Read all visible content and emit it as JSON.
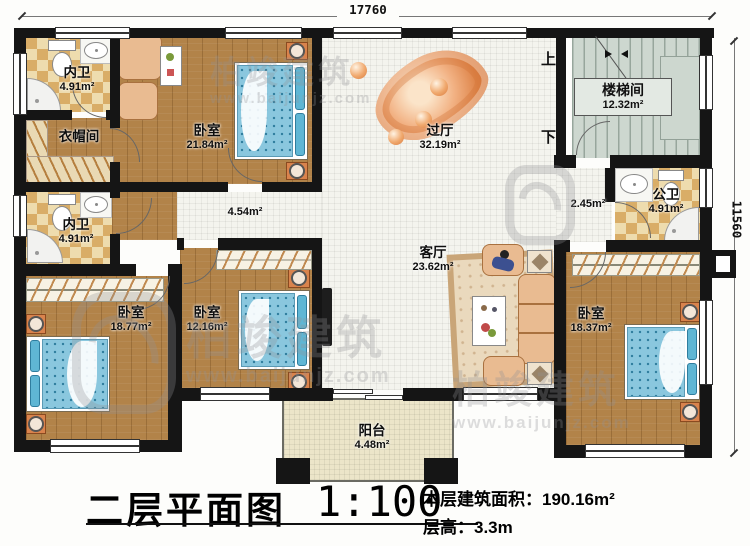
{
  "dimensions": {
    "top": "17760",
    "right": "11560"
  },
  "stairs": {
    "up": "上",
    "down": "下"
  },
  "rooms": {
    "bath_top": {
      "name": "内卫",
      "area": "4.91m²"
    },
    "cloakroom": {
      "name": "衣帽间"
    },
    "bedroom_tl": {
      "name": "卧室",
      "area": "21.84m²"
    },
    "hall": {
      "name": "过厅",
      "area": "32.19m²"
    },
    "stairwell": {
      "name": "楼梯间",
      "area": "12.32m²"
    },
    "corridor": {
      "area": "4.54m²"
    },
    "bath_mid": {
      "name": "内卫",
      "area": "4.91m²"
    },
    "corridor_right": {
      "area": "2.45m²"
    },
    "bath_public": {
      "name": "公卫",
      "area": "4.91m²"
    },
    "living": {
      "name": "客厅",
      "area": "23.62m²"
    },
    "bedroom_bl": {
      "name": "卧室",
      "area": "18.77m²"
    },
    "bedroom_bm": {
      "name": "卧室",
      "area": "12.16m²"
    },
    "bedroom_br": {
      "name": "卧室",
      "area": "18.37m²"
    },
    "balcony": {
      "name": "阳台",
      "area": "4.48m²"
    }
  },
  "title_block": {
    "plan_title": "二层平面图",
    "scale": "1:100",
    "area_text": "本层建筑面积：190.16m²",
    "floor_height_text": "层高：3.3m"
  },
  "watermark": {
    "brand": "柏竣建筑",
    "url": "www.baijunjz.com"
  },
  "colors": {
    "wall": "#151515",
    "wood": "#b28349",
    "checker_light": "#eedcae",
    "checker_dark": "#d9ad67",
    "tile": "#f4f4ee",
    "stair": "#cdd7cf",
    "balcony": "#ece5c9",
    "bed": "#8ac7de",
    "nightstand": "#d9834d",
    "rug": "#e0824a",
    "sofa": "#e9bb91"
  }
}
